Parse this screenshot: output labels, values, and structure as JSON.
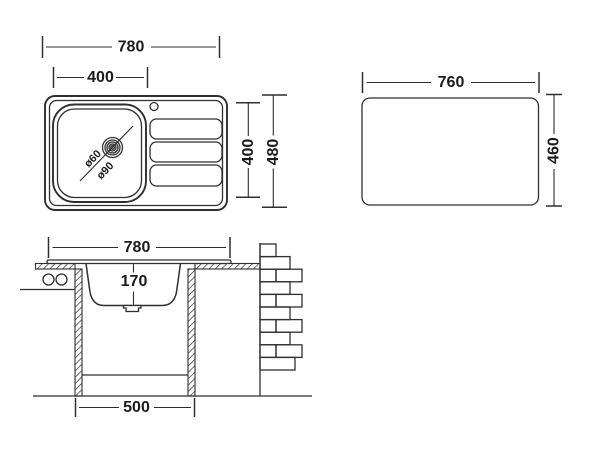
{
  "colors": {
    "line": "#2f2f2f",
    "text": "#1b1b1b",
    "background": "#ffffff"
  },
  "top_view": {
    "overall_width": "780",
    "bowl_width": "400",
    "bowl_length": "400",
    "overall_depth": "480",
    "drain_small_diameter": "ø60",
    "drain_large_diameter": "ø90"
  },
  "cutout_view": {
    "width": "760",
    "height": "460"
  },
  "section_view": {
    "overall_width": "780",
    "bowl_depth": "170",
    "cabinet_width": "500"
  }
}
